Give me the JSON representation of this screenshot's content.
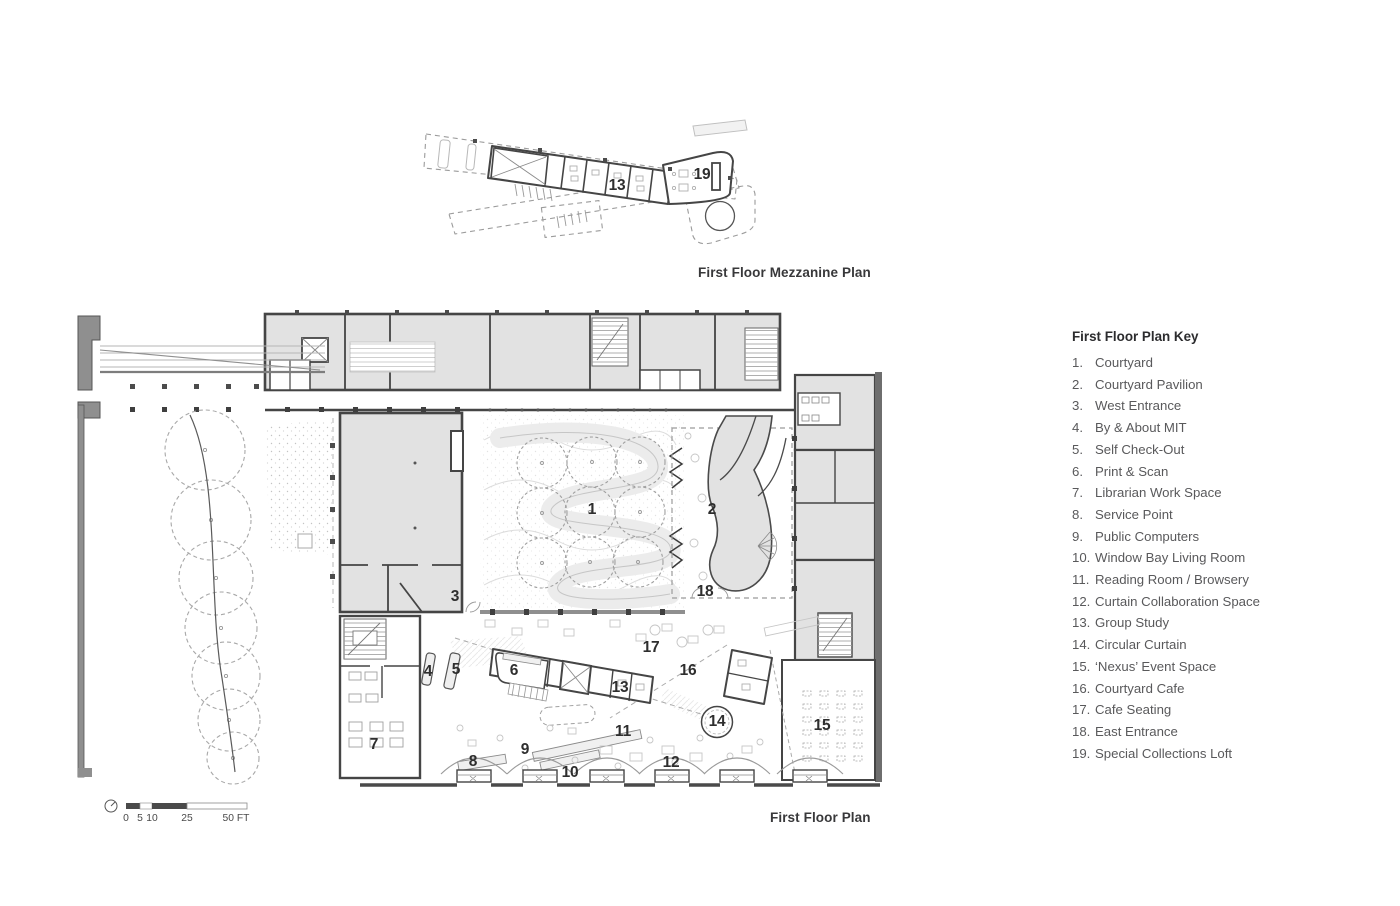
{
  "colors": {
    "room_fill": "#e2e2e2",
    "wall": "#454545",
    "site_wall": "#8f8f8f",
    "dashed_line": "#9b9b9b",
    "light_line": "#c6c6c6",
    "key_text": "#59595b",
    "title_text": "#38383a"
  },
  "mezzanine_plan": {
    "title": "First Floor Mezzanine Plan",
    "labels": [
      {
        "text": "13",
        "x": 202,
        "y": 68
      },
      {
        "text": "19",
        "x": 287,
        "y": 57
      }
    ]
  },
  "first_floor_plan": {
    "title": "First Floor Plan",
    "labels": [
      {
        "text": "1",
        "x": 522,
        "y": 212
      },
      {
        "text": "2",
        "x": 642,
        "y": 212
      },
      {
        "text": "3",
        "x": 385,
        "y": 299
      },
      {
        "text": "4",
        "x": 358,
        "y": 374
      },
      {
        "text": "5",
        "x": 386,
        "y": 372
      },
      {
        "text": "6",
        "x": 444,
        "y": 373
      },
      {
        "text": "7",
        "x": 304,
        "y": 447
      },
      {
        "text": "8",
        "x": 403,
        "y": 464
      },
      {
        "text": "9",
        "x": 455,
        "y": 452
      },
      {
        "text": "10",
        "x": 500,
        "y": 475
      },
      {
        "text": "11",
        "x": 553,
        "y": 434
      },
      {
        "text": "12",
        "x": 601,
        "y": 465
      },
      {
        "text": "13",
        "x": 550,
        "y": 390
      },
      {
        "text": "14",
        "x": 647,
        "y": 424
      },
      {
        "text": "15",
        "x": 752,
        "y": 428
      },
      {
        "text": "16",
        "x": 618,
        "y": 373
      },
      {
        "text": "17",
        "x": 581,
        "y": 350
      },
      {
        "text": "18",
        "x": 635,
        "y": 294
      }
    ]
  },
  "key": {
    "title": "First Floor Plan Key",
    "items": [
      {
        "num": "1.",
        "label": "Courtyard"
      },
      {
        "num": "2.",
        "label": "Courtyard Pavilion"
      },
      {
        "num": "3.",
        "label": "West Entrance"
      },
      {
        "num": "4.",
        "label": "By & About MIT"
      },
      {
        "num": "5.",
        "label": "Self Check-Out"
      },
      {
        "num": "6.",
        "label": "Print & Scan"
      },
      {
        "num": "7.",
        "label": "Librarian Work Space"
      },
      {
        "num": "8.",
        "label": "Service Point"
      },
      {
        "num": "9.",
        "label": "Public Computers"
      },
      {
        "num": "10.",
        "label": "Window Bay Living Room"
      },
      {
        "num": "11.",
        "label": "Reading Room / Browsery"
      },
      {
        "num": "12.",
        "label": "Curtain Collaboration Space"
      },
      {
        "num": "13.",
        "label": "Group Study"
      },
      {
        "num": "14.",
        "label": "Circular Curtain"
      },
      {
        "num": "15.",
        "label": "‘Nexus’ Event Space"
      },
      {
        "num": "16.",
        "label": "Courtyard Cafe"
      },
      {
        "num": "17.",
        "label": "Cafe Seating"
      },
      {
        "num": "18.",
        "label": "East Entrance"
      },
      {
        "num": "19.",
        "label": "Special Collections Loft"
      }
    ]
  },
  "scale_bar": {
    "ticks": [
      {
        "text": "0",
        "x": 26
      },
      {
        "text": "5",
        "x": 40
      },
      {
        "text": "10",
        "x": 52
      },
      {
        "text": "25",
        "x": 87
      },
      {
        "text": "50 FT",
        "x": 136
      }
    ]
  }
}
